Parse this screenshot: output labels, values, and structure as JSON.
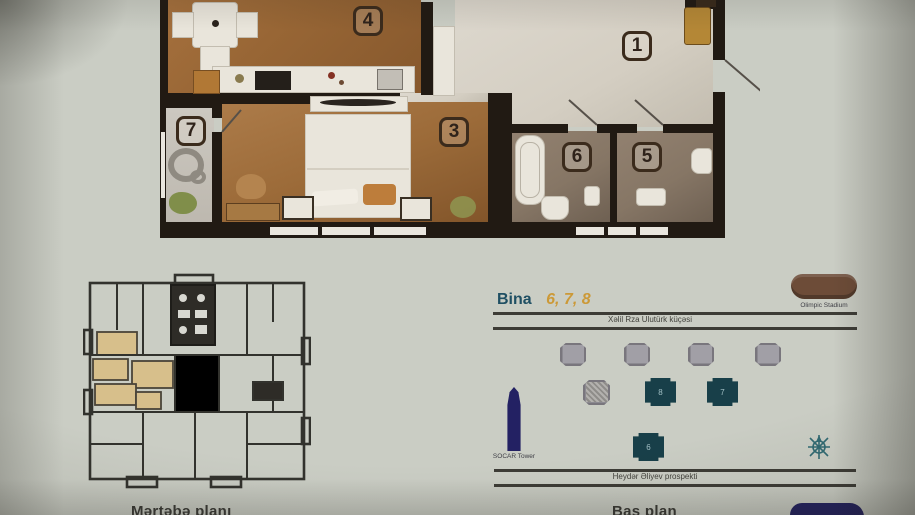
{
  "captions": {
    "floor_plate": "Mərtəbə planı",
    "site_plan": "Baş plan"
  },
  "apartment": {
    "rooms": [
      {
        "label": "4"
      },
      {
        "label": "1"
      },
      {
        "label": "3"
      },
      {
        "label": "7"
      },
      {
        "label": "6"
      },
      {
        "label": "5"
      }
    ]
  },
  "site_plan": {
    "title": {
      "prefix": "Bina",
      "numbers": "6, 7, 8"
    },
    "streets": {
      "top": "Xəlil Rza Ulutürk küçəsi",
      "bottom": "Heydər Əliyev prospekti"
    },
    "landmarks": {
      "tower": "SOCAR Tower",
      "stadium": "Olimpic Stadium"
    },
    "buildings": [
      {
        "label": "8"
      },
      {
        "label": "7"
      },
      {
        "label": "6"
      }
    ]
  },
  "colors": {
    "paper": "#cacdc4",
    "wall": "#221a12",
    "wood": "#9c6530",
    "hall": "#d7d2c6",
    "bath": "#877663",
    "highlight_apartment": "#d9bf86",
    "teal_building": "#15404a",
    "navy": "#232166",
    "stadium_brown": "#6f4c36",
    "title_blue": "#1c5066",
    "title_orange": "#d0992e"
  }
}
